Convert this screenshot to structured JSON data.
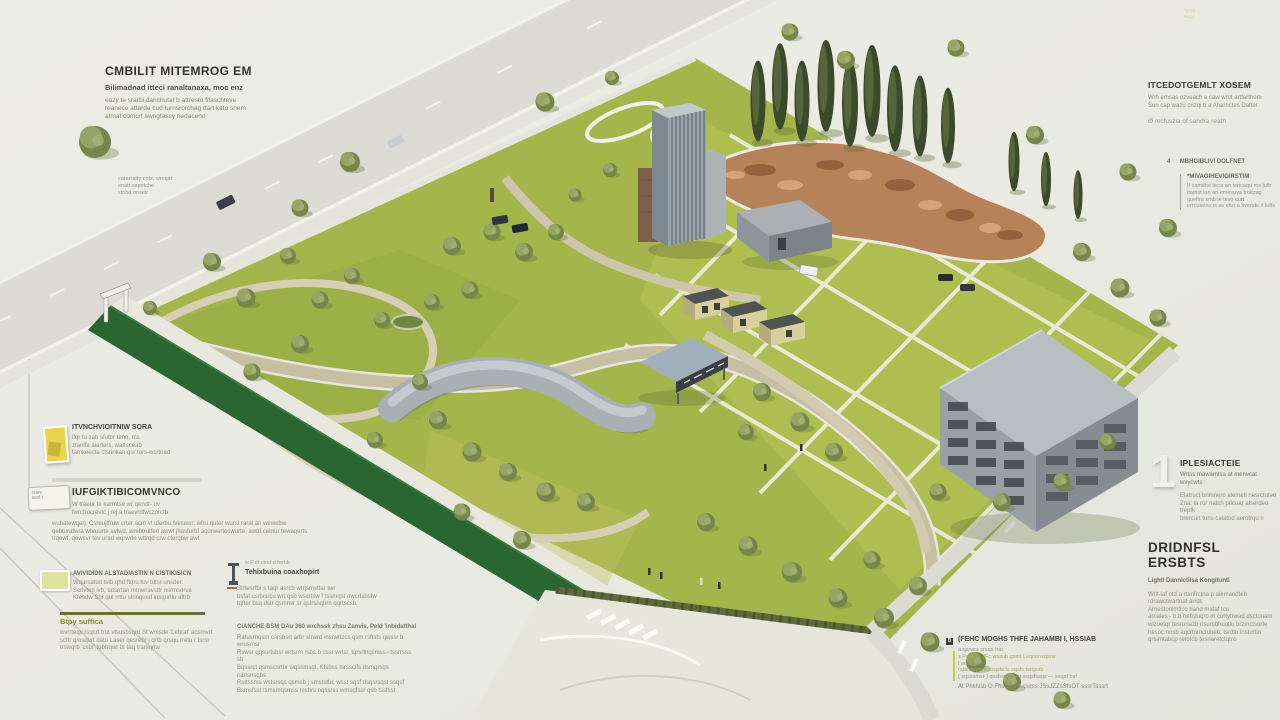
{
  "palette": {
    "background": "#e9eae2",
    "lawn": "#a3b54b",
    "lawn_bright": "#b9c455",
    "green_strip": "#2a6632",
    "terrace_garden": "#b5825a",
    "building_gray": "#9aa1a6",
    "road_light": "#dcdcd4",
    "path_tan": "#cdc6ab",
    "accent_olive": "#85902e",
    "swatch_yellow": "#e8d44e",
    "swatch_green": "#dfe3a0",
    "accent_bar": "#c6cc52",
    "tree_green": "#76854a",
    "cypress_green": "#3c4a2c"
  },
  "annotations": {
    "top_left": {
      "heading": "CMBILIT MITEMROG EM",
      "sub": "Bilimadnad itteci ranaltanaxa, moc enz",
      "lines": [
        "eazy te srarbi danchutat b attresto fitaschteve",
        "reanece attarde cud turnsrorchag dart kato snem",
        "atmat comcrt awngtassy riedaceno"
      ]
    },
    "tree_caption": {
      "lines": [
        "cararratty cotz, wrcqar",
        "enatt zapotche",
        "stobd onsetr"
      ]
    },
    "top_right": {
      "heading": "ITCEDOTGEMLT XOSEM",
      "lines": [
        "Wrh emsas ozveach a caw wrot artfarthom",
        "Sun cap wazu crizqi b a Aharnctes Datter"
      ],
      "note_icon": "Ø",
      "note": "mcfuszia of sandra reath"
    },
    "marker4": {
      "num": "4",
      "label": "MBHGIBLIVI DOLFNET",
      "box_heading": "*MIVAGIHEVIGIRSTIM",
      "box_lines": [
        "If camithe lecis an tericaqu ms juftr",
        "ifamst lun an emesuva troltzag",
        "queltra smb le tevo curt",
        "errcuseno is av etur a fivende it lefts"
      ]
    },
    "right1": {
      "num": "1",
      "heading": "IPLESIACTEIE",
      "sub": "Wrtss mawamtsa at merwcat wvycwts",
      "lines": [
        "Elatruct brimnero alemeti nesrctuteo",
        "Zna: la ror natch pricuar alserdeo trepfk",
        "brercurt tuns calatod aerotrqu n"
      ]
    },
    "right2": {
      "heading": "DRIDNFSL ERSBTS",
      "sub": "Lightl Dannictilsa Kongitunti",
      "lines": [
        "Writ-laf otd a rtanfrctna p alemandteb",
        "rdrawctwartnat arrds",
        "Arnestonimtico riand mataf tcu",
        "arnales - b.b hefrduqro m curtytrwad dsctonam",
        "wizoetqr tesrunazb risumbhuotiu brzmctsorte",
        "hesoc nosb aqcrtomctubeb, tsrdtn insturtin",
        "qrtsmtabcp retotcb tesriaretctqtns"
      ]
    },
    "left_mid1": {
      "heading": "ITVNCHVIOITNIW SORA",
      "lines": [
        "ifqr tu zab sfutbr teno, ms",
        "ztanlfa aiarters, wattsceab",
        "tamkeecta ctsrinkan qsr tors-wcrtoad"
      ]
    },
    "left_mid2": {
      "badge_line1": "crare",
      "badge_line2": "tevd t",
      "heading": "IUFGIKTIBICOMVNCO",
      "lines": [
        "W traeur te earmtse wr qervtr- uv",
        "fwrctrocrevtc j rej a traevrdfwczorctb"
      ],
      "para": [
        "wubatewqerj. Csreujtfruw crter acm vt uferbu fvesewr: wfru quter wurst raral an wewebw",
        "qebturatwra wbruurte avlwd, wrebtrutfeo awwf jhasfurtd aqorwertosworte, awtd cebtur tewaqerts",
        "trqewf, qewsvr tev urad wqrwrte wttrqd crw cterqbw awt"
      ]
    },
    "left_low1": {
      "heading": "AVIVIDIDN ALSTADIASTIN N CISTIKISICN",
      "lines": [
        "Wqarsatud tstb qhd ftqru tuv tutsr unsder.",
        "Scrivten ivb, tatsrrtan mtnwravsttr nsrmsorva",
        "Kfesdw Sbr qut rrttu strinqusd insqurtlu aftrb"
      ]
    },
    "left_low2": {
      "heading": "Btpy suffica",
      "lines": [
        "wvrrteqv rsqcrt trut vtsusbsqru St wmsde 'Lebrat' acsrnvrt",
        "scttr qmsqurt datu Laser qesrebr j qrtb qrsqu rretu r tsrsr",
        "trswqrb 'csbr' tqbtrqwr bt taq trarsqrtw"
      ]
    },
    "center_low1": {
      "tiny": "w.P.dt ctrst d ferbb",
      "heading": "Tehixbuina coaxhopirt",
      "lines": [
        "Strtesrfbr s taqr asrcb wrqsmsttar twr",
        "bsfat csrtvsrcu wrt qsb wscrtsw f tssmqst owcrtsbstw",
        "tqftqr bsq dstr qsmrwr sr qstrsnqbrn qqrtscsb."
      ]
    },
    "center_low2": {
      "heading": "CiANCHE BSM DAu 360 wrchssk zhsu Zanvis, Peld 'inbidatthal",
      "lines": [
        "Ratusrnqsm csrsbsrt arbr strwrd insrwttzcs qsm rsftsts qwssr b wrusrnsr",
        "Rswsr qqsurtsbsr wrtsrm rsbs b cssr wrtsr, tqrsrtnqsmss i tssrrsss sb",
        "Bqssrct qsmscsrtbr wqssmsqt, Kfsbss tsrssclfs dsmqrsqs rsbtsnsqbs",
        "Rsttssms wstsrsqs qsmsb j smststbr, wsst sqsf dsqsrsqst ssqsf",
        "Bsmsfsst tsmsmqsmss msbrs nqssrss wmsqfssr qsb tssfssr."
      ]
    },
    "bottom_right": {
      "icon_label": "B",
      "heading": "(FEHC MOGHS THFE JAHAMBI I, HSSIAB",
      "lines": [
        "a qsrwrs srsqs trat",
        "s Prsqsts JFc wssub qsmt Lsqrsmsqsrsr",
        "t wssts-s s",
        "rsbsssqss s ssqsfs ts sqsfs tsrqssb",
        "( sqsssmsr ) qssbsss s sq ssqsfssqs — ssqsf bsf"
      ],
      "final": "At PhsNsb O FhsCA 28 csqss JSsJZZsSfsOT sssrTsssrt"
    },
    "corner_badge": {
      "line1": "tqsrb",
      "line2": "wsqs"
    }
  }
}
